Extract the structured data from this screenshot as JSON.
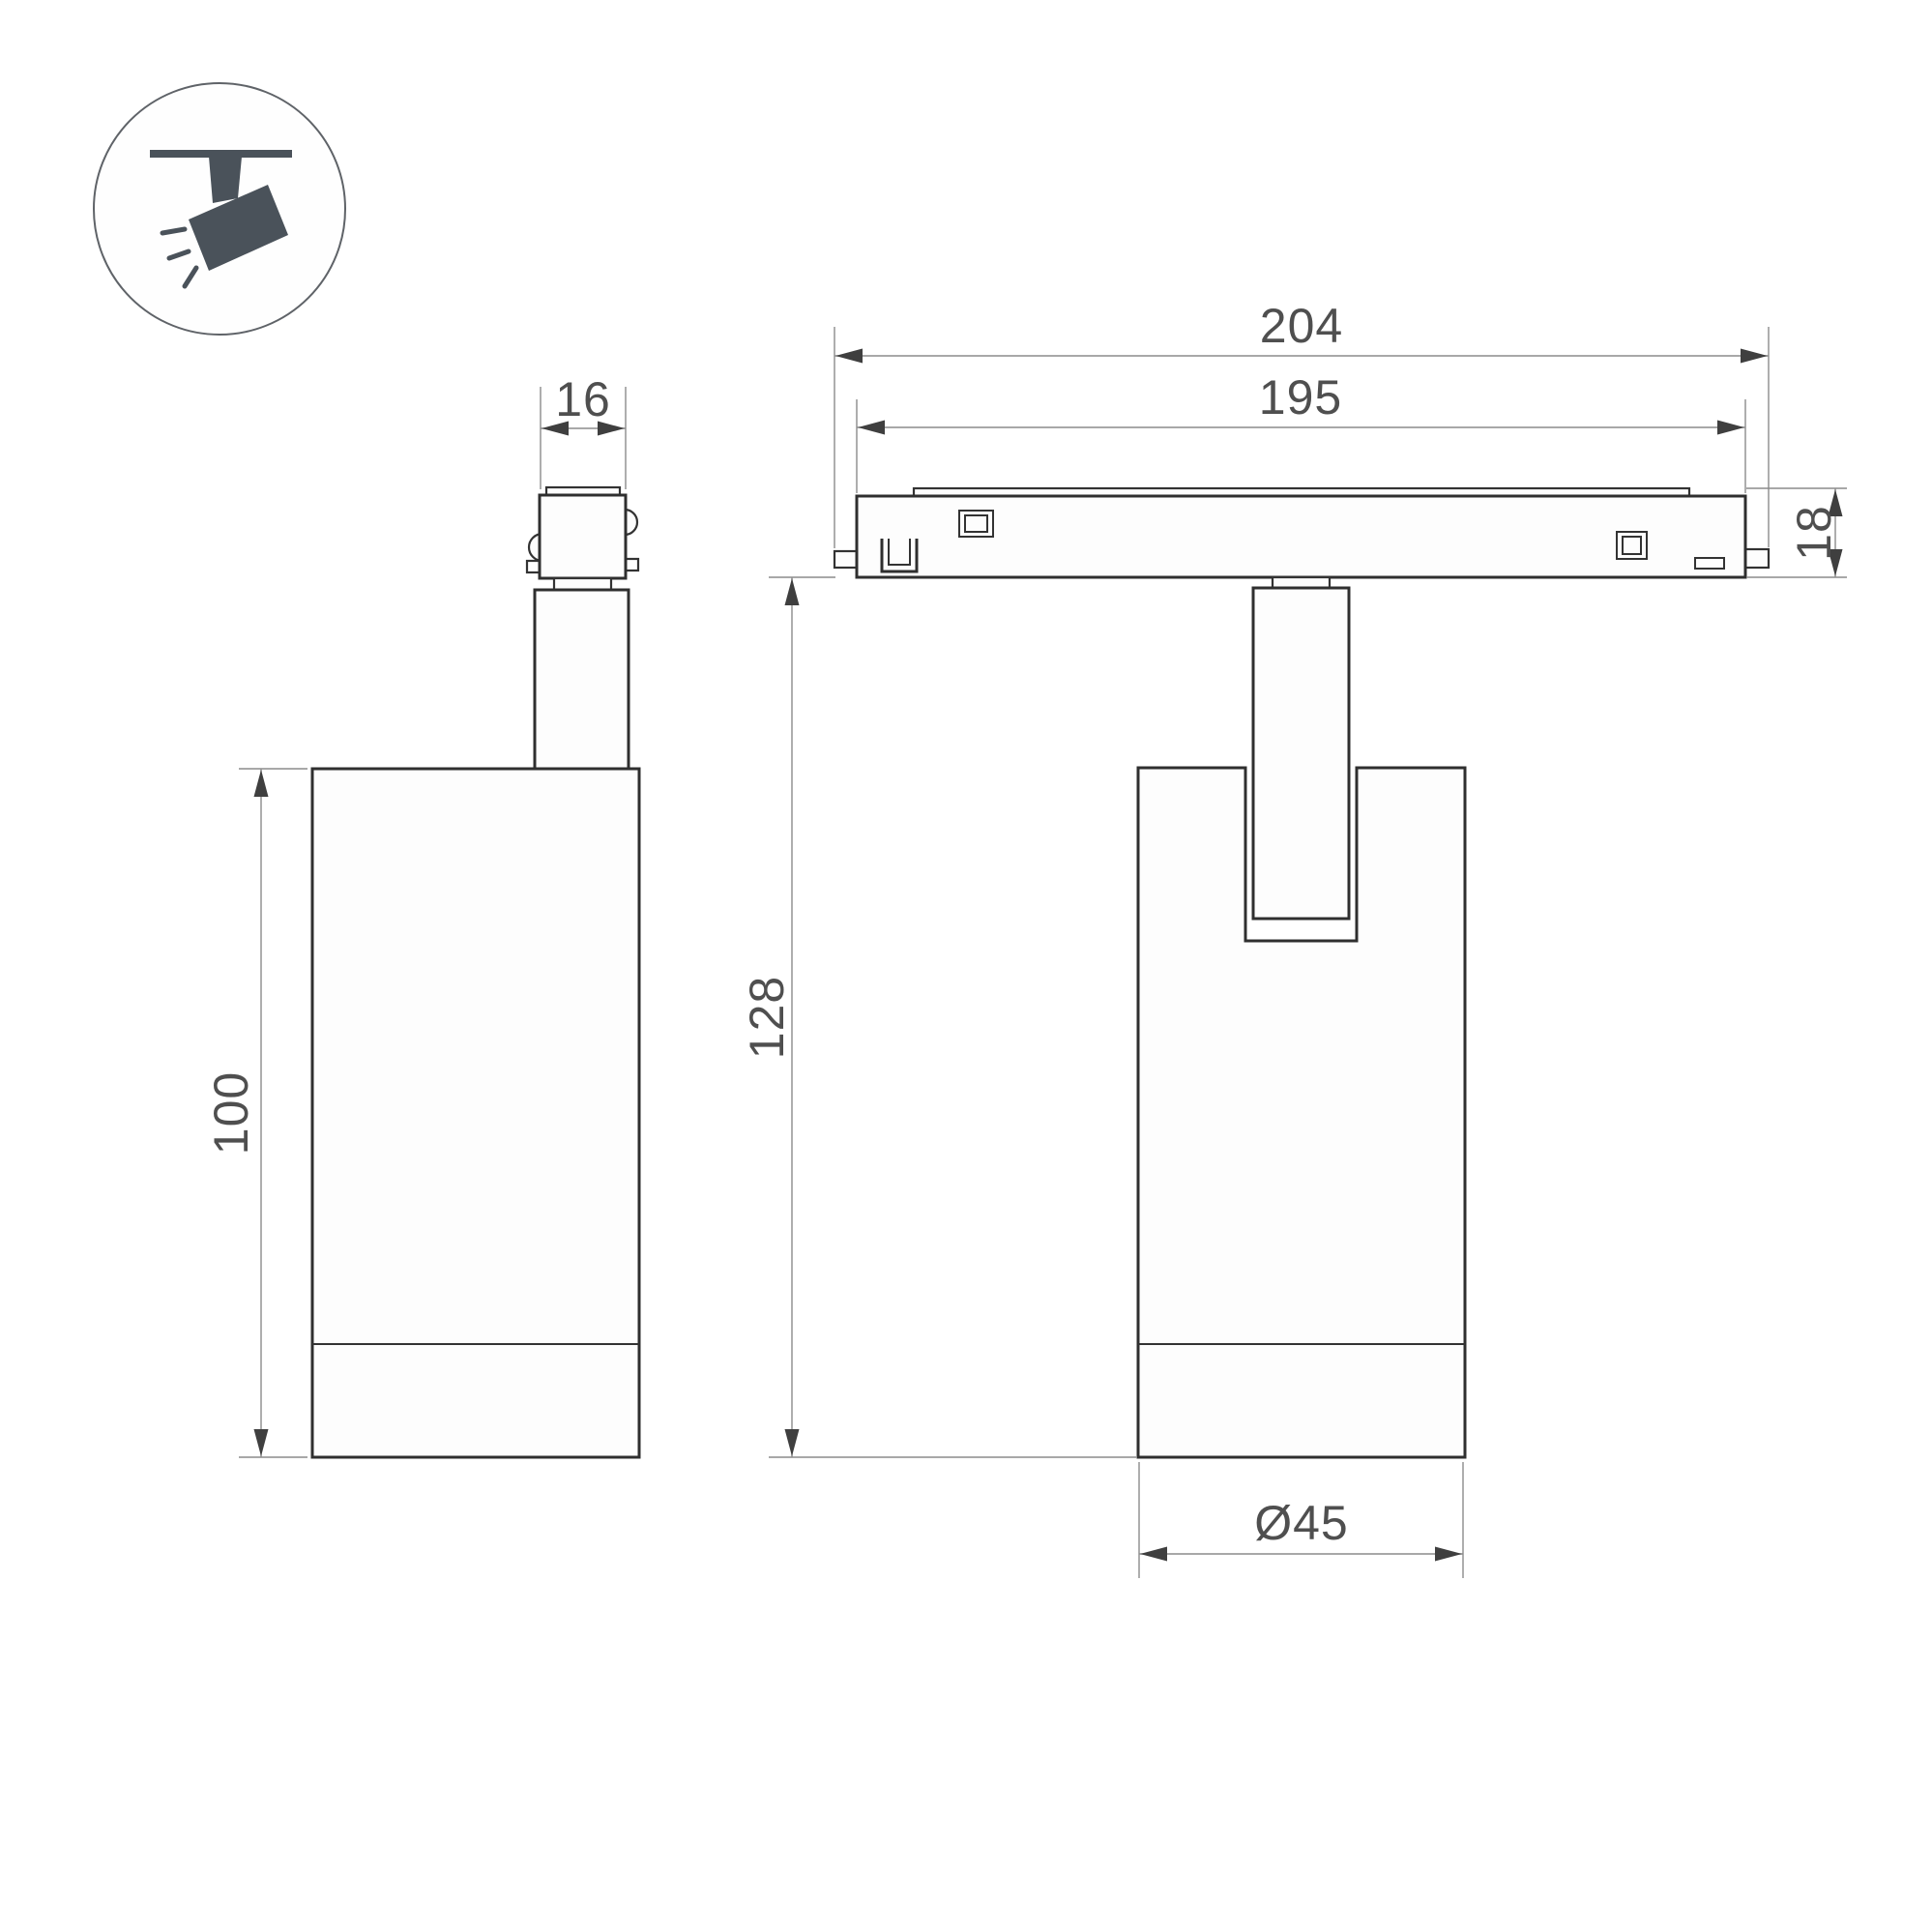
{
  "colors": {
    "background": "#ffffff",
    "outline": "#2f2f2f",
    "dim_line": "#8c8c8c",
    "arrow": "#3f3f3f",
    "dim_text": "#4f4f4f",
    "icon": "#4a525a"
  },
  "dimensions": {
    "track_length_overall": "204",
    "track_length_body": "195",
    "track_height": "18",
    "total_drop_height": "128",
    "body_height": "100",
    "adapter_width": "16",
    "body_diameter": "Ø45"
  }
}
